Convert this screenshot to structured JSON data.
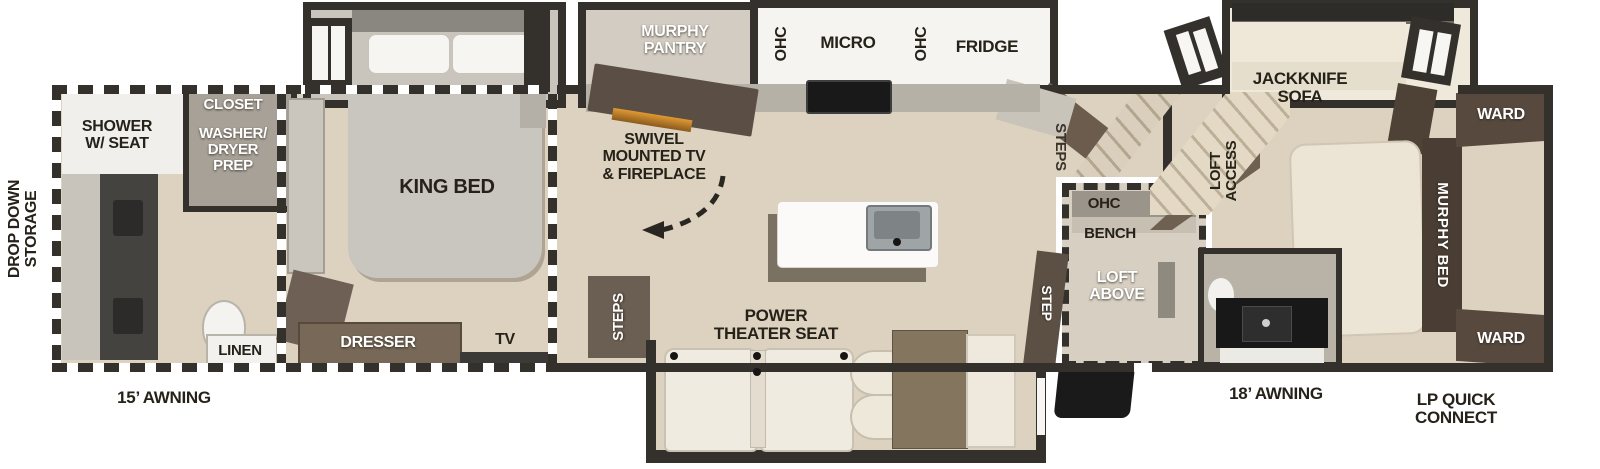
{
  "title": "fifth-wheel-floorplan",
  "colors": {
    "wall": "#34312c",
    "floor": "#ddd2bf",
    "cabinet_brown": "#6b5d50",
    "dark_brown": "#4a3e34",
    "cream_furniture": "#efe9dc",
    "counter_gray": "#b6b1a7",
    "fireplace_accent": "#d98a2b",
    "label_dark": "#262219",
    "label_white": "#ffffff"
  },
  "exterior": {
    "drop_down_storage": "DROP DOWN\nSTORAGE",
    "awning_front": "15’ AWNING",
    "awning_rear": "18’ AWNING",
    "lp_quick_connect": "LP QUICK\nCONNECT"
  },
  "bathroom": {
    "shower": "SHOWER\nW/ SEAT",
    "closet": "CLOSET",
    "washer_dryer_prep": "WASHER/\nDRYER\nPREP",
    "linen": "LINEN"
  },
  "bedroom": {
    "king_bed": "KING BED",
    "dresser": "DRESSER",
    "tv": "TV"
  },
  "kitchen": {
    "murphy_pantry": "MURPHY\nPANTRY",
    "ohc_left": "OHC",
    "micro": "MICRO",
    "ohc_right": "OHC",
    "fridge": "FRIDGE",
    "swivel_tv_fireplace": "SWIVEL\nMOUNTED TV\n& FIREPLACE"
  },
  "living": {
    "steps_front": "STEPS",
    "power_theater_seat": "POWER\nTHEATER SEAT"
  },
  "mid": {
    "steps_rear": "STEPS",
    "ohc": "OHC",
    "bench": "BENCH",
    "loft_above": "LOFT\nABOVE",
    "step_entry": "STEP"
  },
  "rear": {
    "jackknife_sofa": "JACKKNIFE\nSOFA",
    "loft_access": "LOFT\nACCESS",
    "murphy_bed": "MURPHY BED",
    "ward_top": "WARD",
    "ward_bottom": "WARD"
  }
}
